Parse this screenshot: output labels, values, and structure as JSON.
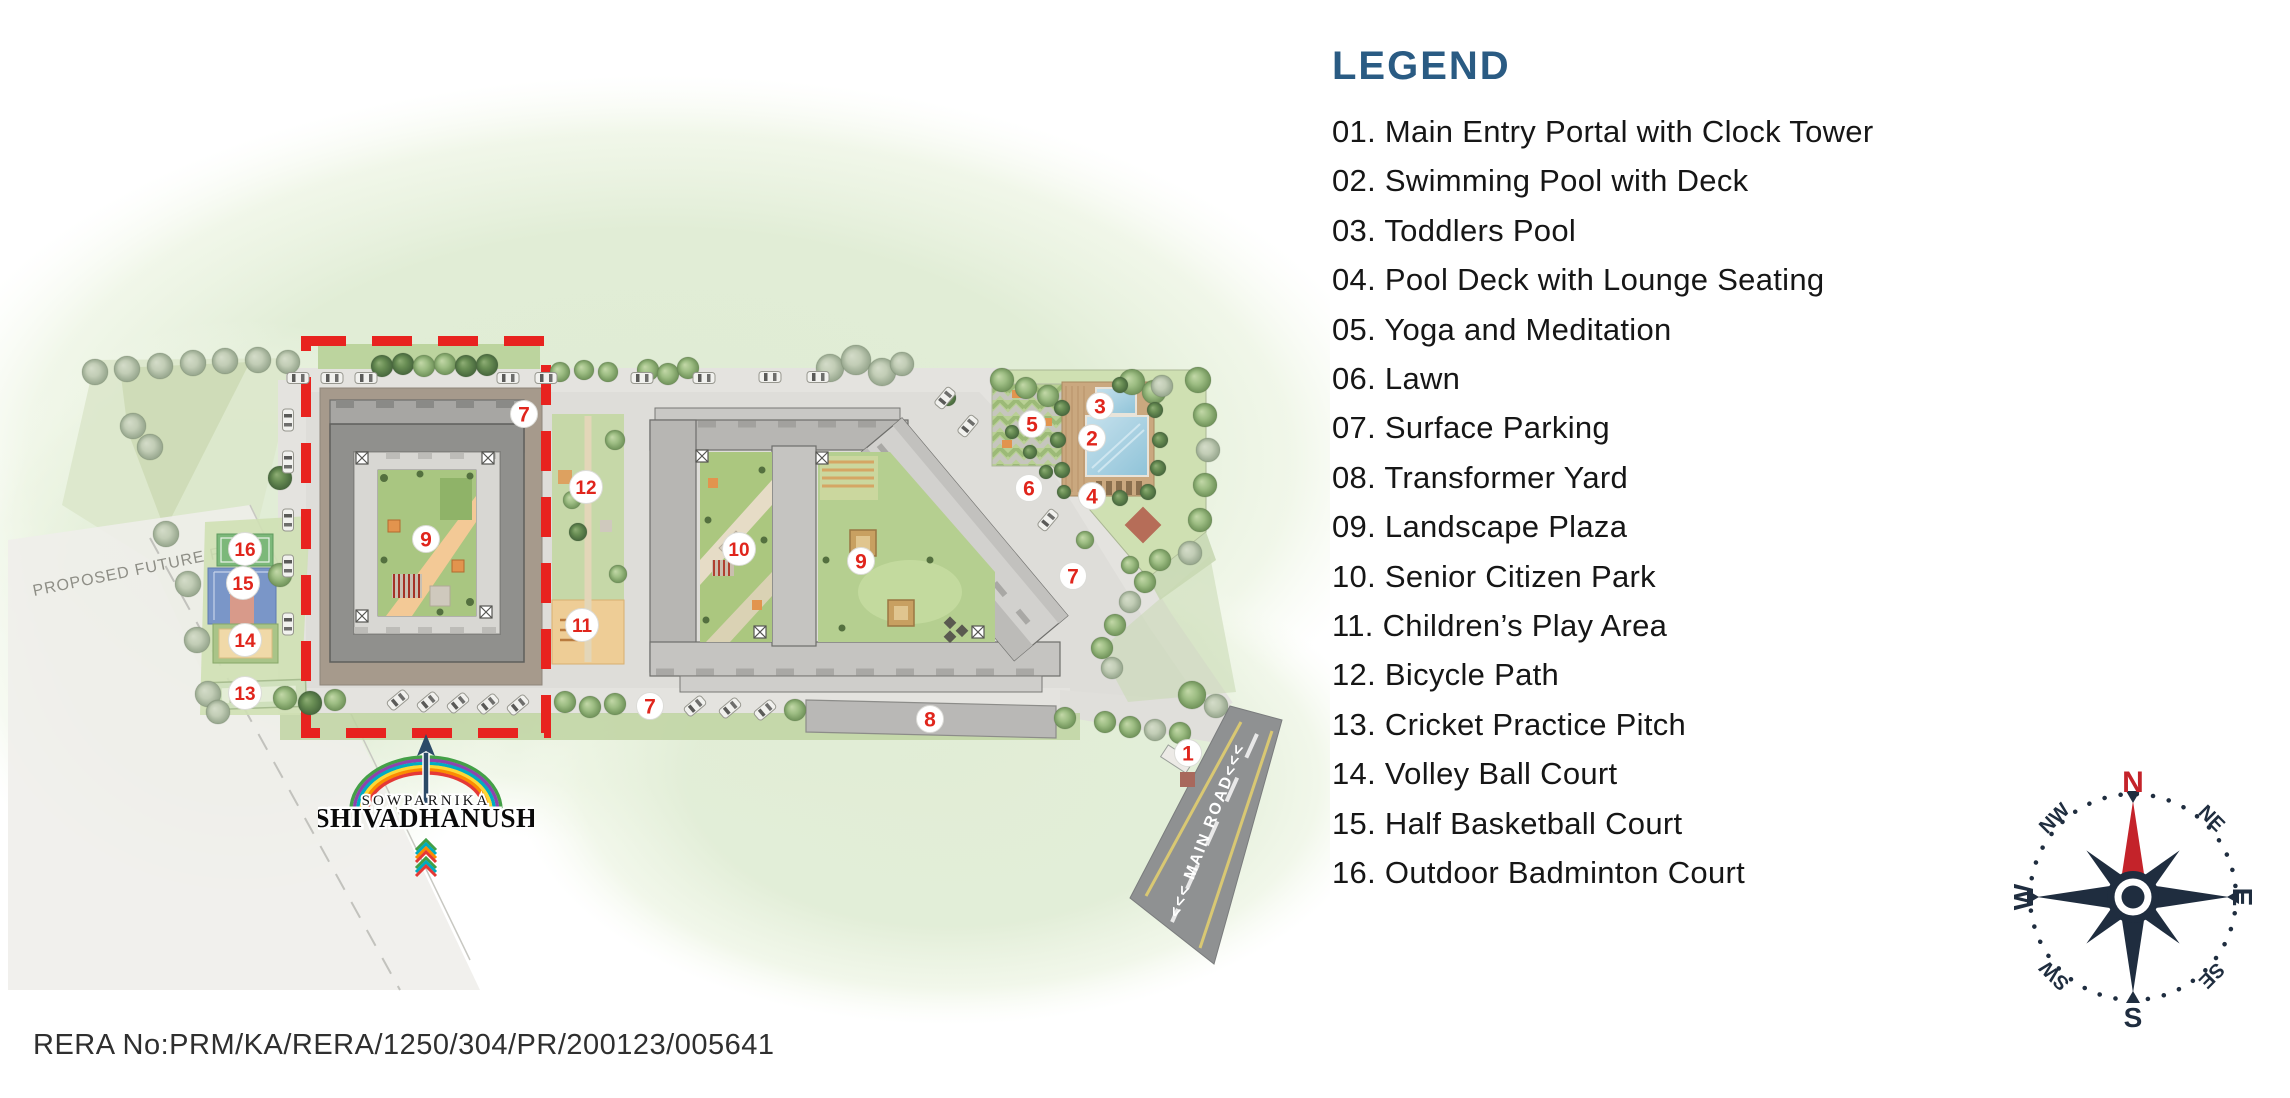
{
  "legend": {
    "title": "LEGEND",
    "items": [
      {
        "num": "01",
        "label": "Main Entry Portal with Clock Tower"
      },
      {
        "num": "02",
        "label": "Swimming Pool with Deck"
      },
      {
        "num": "03",
        "label": "Toddlers Pool"
      },
      {
        "num": "04",
        "label": "Pool Deck with Lounge Seating"
      },
      {
        "num": "05",
        "label": "Yoga and Meditation"
      },
      {
        "num": "06",
        "label": "Lawn"
      },
      {
        "num": "07",
        "label": "Surface Parking"
      },
      {
        "num": "08",
        "label": "Transformer Yard"
      },
      {
        "num": "09",
        "label": "Landscape Plaza"
      },
      {
        "num": "10",
        "label": "Senior Citizen Park"
      },
      {
        "num": "11",
        "label": "Children’s Play Area"
      },
      {
        "num": "12",
        "label": "Bicycle Path"
      },
      {
        "num": "13",
        "label": "Cricket Practice Pitch"
      },
      {
        "num": "14",
        "label": "Volley Ball Court"
      },
      {
        "num": "15",
        "label": "Half Basketball Court"
      },
      {
        "num": "16",
        "label": "Outdoor Badminton Court"
      }
    ]
  },
  "map": {
    "main_road_label": "<<< MAIN ROAD<<<",
    "future_road_label": "PROPOSED FUTURE ROAD",
    "markers": [
      {
        "label": "7",
        "x": 524,
        "y": 414
      },
      {
        "label": "12",
        "x": 586,
        "y": 487
      },
      {
        "label": "3",
        "x": 1100,
        "y": 406
      },
      {
        "label": "5",
        "x": 1032,
        "y": 424
      },
      {
        "label": "2",
        "x": 1092,
        "y": 438
      },
      {
        "label": "6",
        "x": 1029,
        "y": 488
      },
      {
        "label": "4",
        "x": 1092,
        "y": 496
      },
      {
        "label": "9",
        "x": 426,
        "y": 539
      },
      {
        "label": "10",
        "x": 739,
        "y": 549
      },
      {
        "label": "9",
        "x": 861,
        "y": 561
      },
      {
        "label": "7",
        "x": 1073,
        "y": 576
      },
      {
        "label": "16",
        "x": 245,
        "y": 549
      },
      {
        "label": "15",
        "x": 243,
        "y": 583
      },
      {
        "label": "14",
        "x": 245,
        "y": 640
      },
      {
        "label": "11",
        "x": 582,
        "y": 625
      },
      {
        "label": "13",
        "x": 245,
        "y": 693
      },
      {
        "label": "7",
        "x": 650,
        "y": 706
      },
      {
        "label": "8",
        "x": 930,
        "y": 719
      },
      {
        "label": "1",
        "x": 1188,
        "y": 753
      }
    ]
  },
  "logo": {
    "brand": "SOWPARNIKA",
    "project": "SHIVADHANUSH"
  },
  "compass": {
    "n": "N",
    "ne": "NE",
    "e": "E",
    "se": "SE",
    "s": "S",
    "sw": "SW",
    "w": "W",
    "nw": "NW"
  },
  "footer": {
    "rera": "RERA No:PRM/KA/RERA/1250/304/PR/200123/005641"
  },
  "colors": {
    "accent_red": "#e8231f",
    "marker_red": "#e0251c",
    "legend_heading": "#2a5b83",
    "compass_navy": "#1f2d3f",
    "compass_north_red": "#c4232a",
    "rera_text": "#2f2f2f"
  }
}
